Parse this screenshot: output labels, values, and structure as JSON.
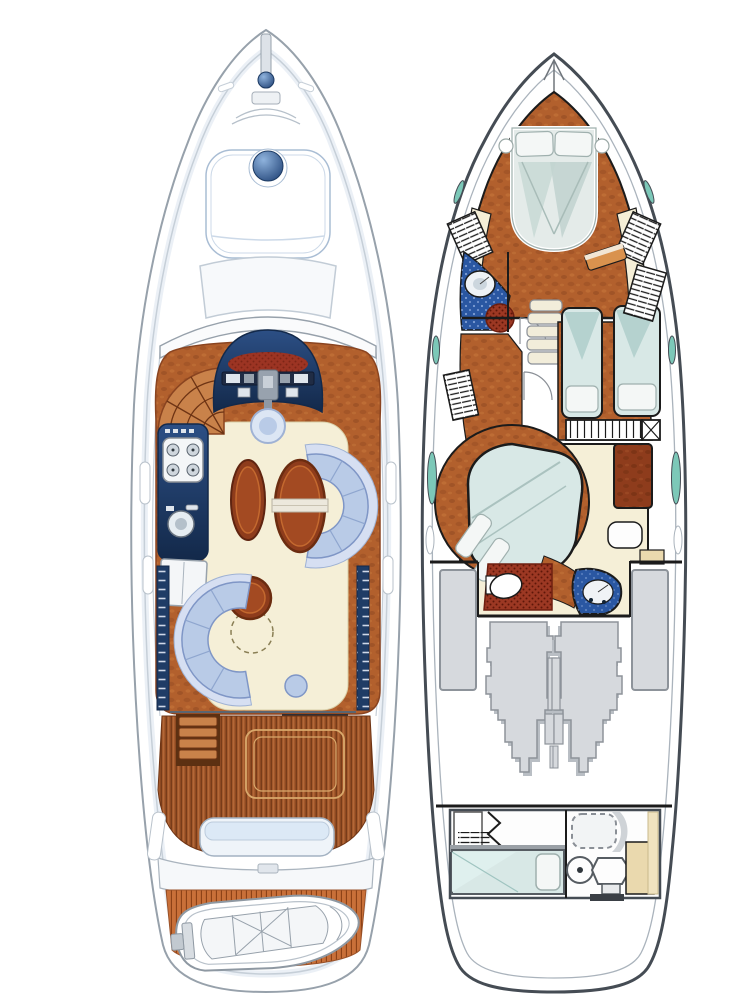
{
  "figure": {
    "type": "motor-yacht floor plan illustration, two deck views side by side, bow pointing up, no text labels",
    "views": [
      {
        "id": "main-deck",
        "position": "left",
        "features": [
          "bow pulpit and anchor windlass",
          "navy hatch dome on sunpad",
          "bow sunpad",
          "foredeck cabin-front panel",
          "curved windshield",
          "helm station with red dash and instruments",
          "helm wheel seat",
          "companionway stair fan",
          "galley with stove, sink and fridge",
          "port and starboard navy window strips",
          "oval sideboard",
          "starboard dinette C-sofa with oval table",
          "port saloon C-sofa with round table and folding leaf (dashed)",
          "aft saloon doorway sill",
          "cockpit teak deck with engine hatch",
          "port cockpit steps",
          "stern bench seat",
          "transom walkway",
          "teak swim platform",
          "tender dinghy with outboard"
        ]
      },
      {
        "id": "lower-deck",
        "position": "right",
        "features": [
          "VIP bow cabin with island double bed and two pillows",
          "bedside shelves",
          "hanging lockers (hatched)",
          "forward head with round basin and red shower mat (blue floor)",
          "companionway stairs",
          "lobby doors",
          "twin guest cabin with two berths and pillows",
          "locker row under twin berths",
          "amidships master cabin with circular wood surround and angled island bed",
          "master head with toilet on red floor",
          "navy washbasin unit with round basin",
          "vanity stool",
          "port and starboard fuel tanks",
          "twin engines (mirrored silhouettes)",
          "aft crew cabin: wardrobe, accordion door, single berth with pillow, dashed shower pan, round basin, toilet, tan cabinets",
          "teal hull windows port and starboard"
        ]
      }
    ]
  },
  "colors": {
    "hullLine": "#97a1ab",
    "hullInner": "#c6cfd8",
    "hullShade": "#dbe4ee",
    "outlineDark": "#454c54",
    "wallInk": "#1b1b1b",
    "navy": "#1f3c66",
    "navyDeep": "#13294a",
    "helmRed": "#9c3423",
    "wood": "#b2602d",
    "woodShadow": "#8a4420",
    "woodDeep": "#8e3c1c",
    "woodRim": "#c4692f",
    "woodLight": "#c9824a",
    "teak": "#a3582b",
    "teakLine": "#6e3414",
    "teakBright": "#c97039",
    "teakBrightLine": "#8a4015",
    "cream": "#f5efd7",
    "creamLine": "#d8cfa8",
    "sofa": "#b9cbe7",
    "sofaLight": "#d6dff2",
    "sofaLine": "#7f96c6",
    "sofaSeam": "#8fa6cf",
    "tableTop": "#a34a22",
    "bedTeal": "#d8e8e6",
    "bedTealDeep": "#b5d2cf",
    "pillow": "#f4f7f6",
    "pillowLine": "#9fb0ae",
    "headBlue": "#2a57a2",
    "headBlueDot": "#7f9fd4",
    "matRed": "#9c3823",
    "matRedDot": "#5e1608",
    "tan": "#ead9ae",
    "tanLight": "#f0e3c0",
    "steel": "#d6d9dd",
    "steelLine": "#8d939a",
    "steelShadow": "#b9bec4",
    "windowTeal": "#7cc8b8"
  }
}
